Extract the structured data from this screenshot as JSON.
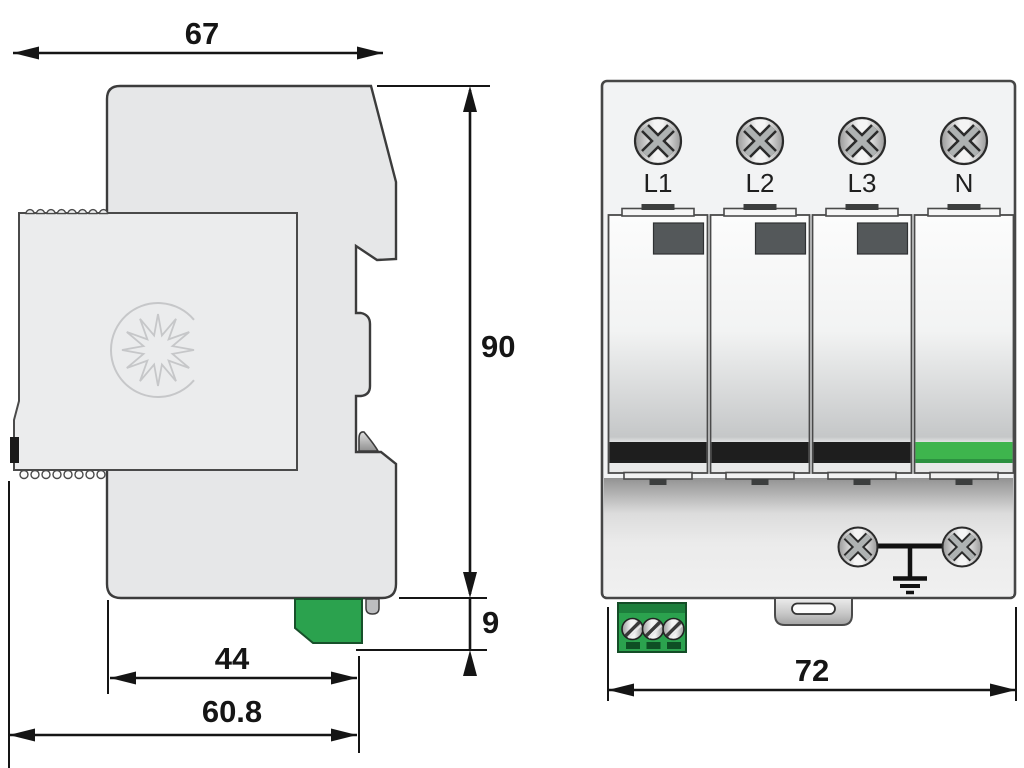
{
  "figure": {
    "kind": "dimensional-drawing",
    "views": [
      "side-view",
      "front-view"
    ]
  },
  "side_view": {
    "dim_overall_width": "67",
    "dim_height": "90",
    "dim_rail_offset": "9",
    "dim_module_width": "44",
    "dim_total_depth": "60.8"
  },
  "front_view": {
    "terminals": [
      "L1",
      "L2",
      "L3",
      "N"
    ],
    "dim_width": "72"
  },
  "colors": {
    "body_gray": "#e6e7e8",
    "outline_dark": "#3c3c3c",
    "dimension_black": "#151515",
    "connector_green": "#2ba24e",
    "status_band_black": "#1e1e1e",
    "status_band_green": "#3eb54d",
    "module_window_gray": "#54585a"
  }
}
